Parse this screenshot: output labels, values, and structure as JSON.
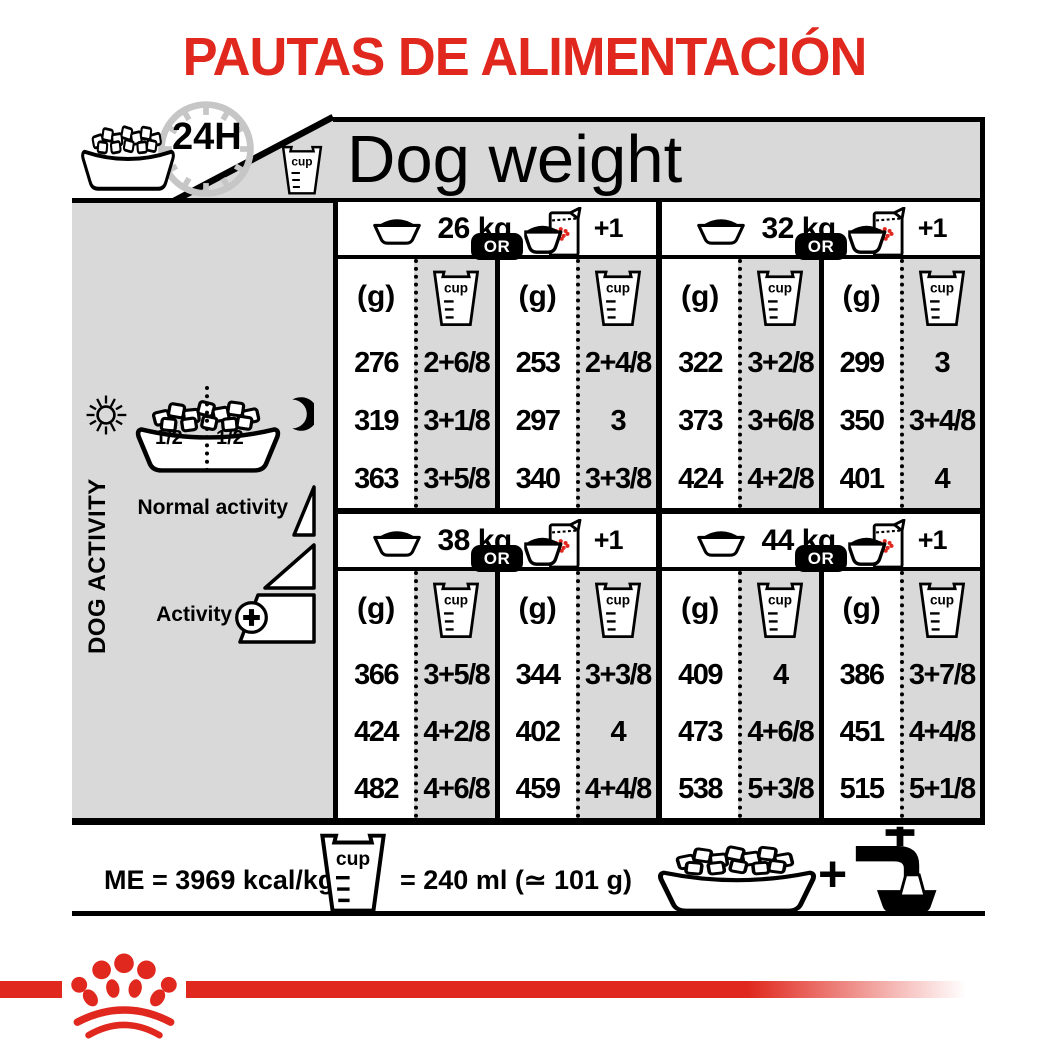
{
  "title": "PAUTAS DE ALIMENTACIÓN",
  "header": {
    "hours_label": "24H",
    "dog_weight_label": "Dog weight",
    "cup_label": "cup"
  },
  "sidebar": {
    "dog_activity_label": "DOG ACTIVITY",
    "normal_activity_label": "Normal activity",
    "activity_label": "Activity",
    "half_left": "1/2",
    "half_right": "1/2"
  },
  "table": {
    "or_label": "OR",
    "plus_one_label": "+1",
    "grams_label": "(g)",
    "cup_label": "cup",
    "sections": [
      {
        "weight": "26 kg",
        "bowl_only": {
          "g": [
            "276",
            "319",
            "363"
          ],
          "cups": [
            "2+6/8",
            "3+1/8",
            "3+5/8"
          ]
        },
        "bowl_plus_pouch": {
          "g": [
            "253",
            "297",
            "340"
          ],
          "cups": [
            "2+4/8",
            "3",
            "3+3/8"
          ]
        }
      },
      {
        "weight": "32 kg",
        "bowl_only": {
          "g": [
            "322",
            "373",
            "424"
          ],
          "cups": [
            "3+2/8",
            "3+6/8",
            "4+2/8"
          ]
        },
        "bowl_plus_pouch": {
          "g": [
            "299",
            "350",
            "401"
          ],
          "cups": [
            "3",
            "3+4/8",
            "4"
          ]
        }
      },
      {
        "weight": "38 kg",
        "bowl_only": {
          "g": [
            "366",
            "424",
            "482"
          ],
          "cups": [
            "3+5/8",
            "4+2/8",
            "4+6/8"
          ]
        },
        "bowl_plus_pouch": {
          "g": [
            "344",
            "402",
            "459"
          ],
          "cups": [
            "3+3/8",
            "4",
            "4+4/8"
          ]
        }
      },
      {
        "weight": "44 kg",
        "bowl_only": {
          "g": [
            "409",
            "473",
            "538"
          ],
          "cups": [
            "4",
            "4+6/8",
            "5+3/8"
          ]
        },
        "bowl_plus_pouch": {
          "g": [
            "386",
            "451",
            "515"
          ],
          "cups": [
            "3+7/8",
            "4+4/8",
            "5+1/8"
          ]
        }
      }
    ]
  },
  "footer": {
    "me_label": "ME = 3969 kcal/kg",
    "cup_label": "cup",
    "cup_equals_label": "= 240 ml (≃ 101 g)",
    "plus_label": "+"
  },
  "colors": {
    "brand_red": "#e0281e",
    "panel_gray": "#d9d9d9"
  }
}
